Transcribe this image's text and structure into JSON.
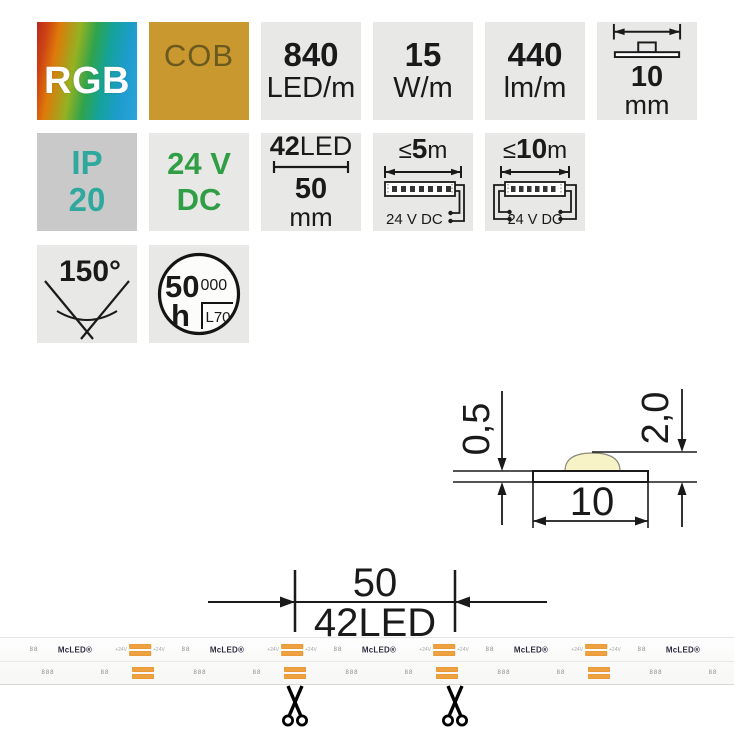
{
  "tiles": {
    "rgb": {
      "label": "RGB"
    },
    "cob": {
      "label": "COB"
    },
    "density": {
      "value": "840",
      "unit": "LED/m"
    },
    "power": {
      "value": "15",
      "unit": "W/m"
    },
    "flux": {
      "value": "440",
      "unit": "lm/m"
    },
    "width": {
      "value": "10",
      "unit": "mm"
    },
    "protection": {
      "line1": "IP",
      "line2": "20"
    },
    "voltage": {
      "line1": "24 V",
      "line2": "DC"
    },
    "module": {
      "count": "42",
      "count_suffix": "LED",
      "length": "50",
      "unit": "mm"
    },
    "run5": {
      "prefix": "≤",
      "value": "5",
      "unit": "m",
      "supply": "24 V DC"
    },
    "run10": {
      "prefix": "≤",
      "value": "10",
      "unit": "m",
      "supply": "24 V DC"
    },
    "angle": {
      "label": "150°"
    },
    "lifetime": {
      "value": "50",
      "zeros": "000",
      "unit": "h",
      "standard": "L70"
    }
  },
  "cross_section": {
    "pcb_thickness": "0,5",
    "total_height": "2,0",
    "width": "10"
  },
  "cut_dimension": {
    "length": "50",
    "led_count": "42LED"
  },
  "strip": {
    "logo": "McLED®",
    "pad_label": "+24V",
    "marks_small": "88",
    "marks_large": "888",
    "top": {
      "logos": [
        75,
        227,
        379,
        531,
        683
      ],
      "pads": [
        140,
        292,
        444,
        596
      ],
      "marks": [
        34,
        186,
        338,
        490,
        642
      ]
    },
    "bottom": {
      "marks_small": [
        105,
        257,
        409,
        561,
        713
      ],
      "pads": [
        143,
        295,
        447,
        599
      ],
      "marks_large": [
        48,
        200,
        352,
        504,
        656
      ]
    }
  },
  "colors": {
    "cob_bg": "#c9992f",
    "cob_text": "#6b5a20",
    "ip_text": "#2fa89d",
    "dc_text": "#2f9e45",
    "pad_orange": "#efa03f",
    "tile_bg": "#e8e8e7",
    "ip_tile_bg": "#c9c9c9",
    "led_dome": "#f8f3c6",
    "rgb_gradient": [
      "#b92a1e",
      "#de7a0a",
      "#93b222",
      "#2fa34d",
      "#14a39a",
      "#2ba4dd"
    ]
  }
}
